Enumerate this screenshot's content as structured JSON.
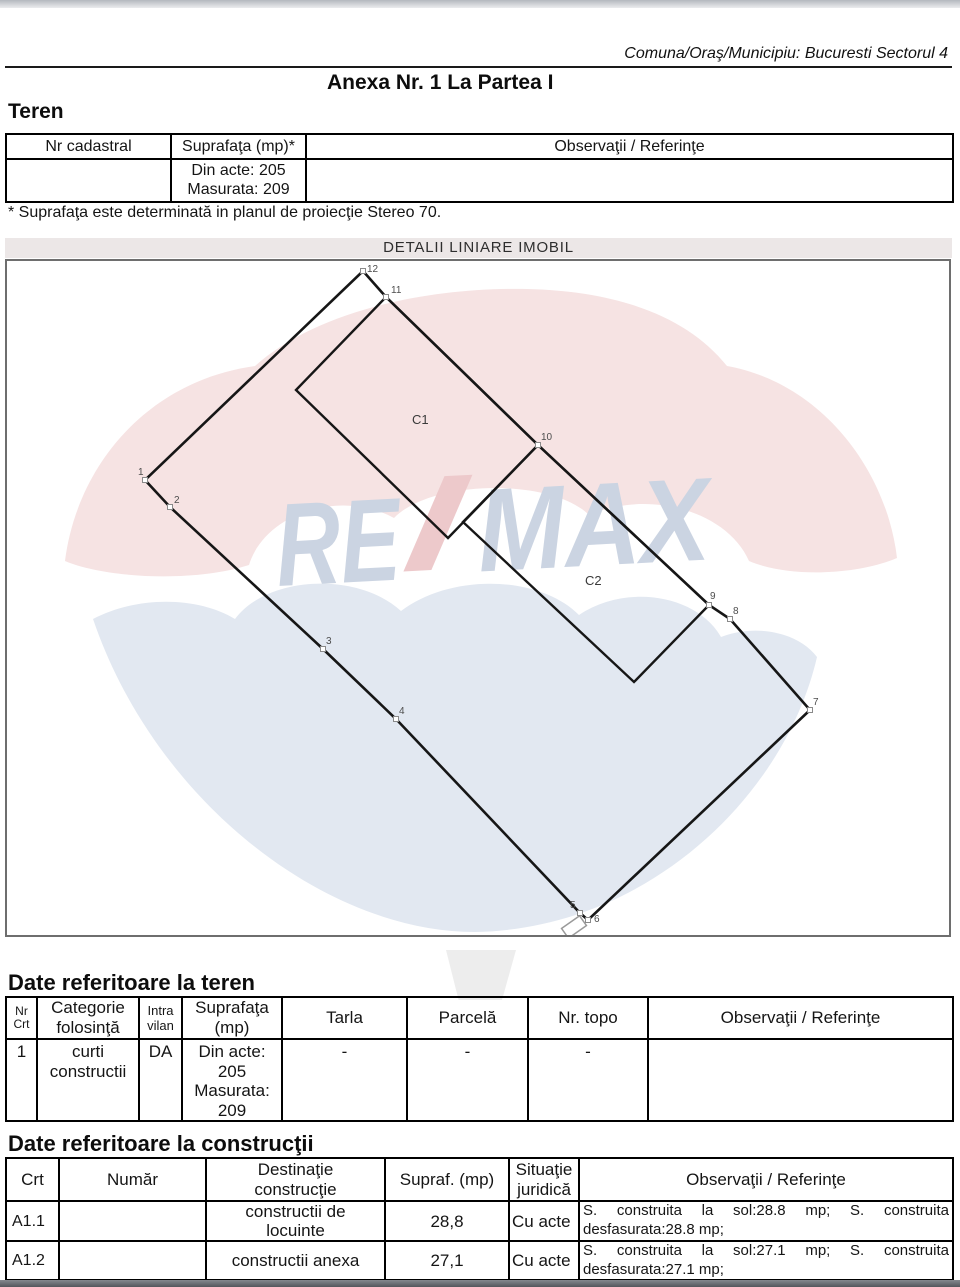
{
  "page": {
    "header_right": "Comuna/Oraş/Municipiu: Bucuresti Sectorul 4",
    "title": "Anexa Nr. 1 La Partea I",
    "teren_heading": "Teren",
    "footnote": "* Suprafaţa este determinată in planul de proiecţie Stereo 70.",
    "detalii_banner": "DETALII LINIARE IMOBIL",
    "date_teren_heading": "Date referitoare la teren",
    "date_constructii_heading": "Date referitoare la construcţii"
  },
  "colors": {
    "banner_bg": "#ece7e7",
    "plan_border": "#6e6e6e",
    "basket_gray": "#ededed"
  },
  "cadastral_table": {
    "headers": [
      "Nr cadastral",
      "Suprafaţa (mp)*",
      "Observaţii / Referinţe"
    ],
    "row": {
      "nr_cadastral": "",
      "suprafata": [
        "Din acte: 205",
        "Masurata: 209"
      ],
      "observatii": ""
    }
  },
  "plan": {
    "building_labels": {
      "c1": "C1",
      "c2": "C2"
    },
    "point_labels": [
      "1",
      "2",
      "3",
      "4",
      "5",
      "6",
      "7",
      "8",
      "9",
      "10",
      "11",
      "12"
    ],
    "watermark": {
      "brand_re": "RE",
      "brand_max": "MAX",
      "pink": "#f6e3e3",
      "blue": "#e2e8f1",
      "letter_blue": "#cbd4e2",
      "letter_red": "#edc9cb"
    }
  },
  "teren_table": {
    "headers": [
      {
        "line1": "Nr",
        "line2": "Crt"
      },
      {
        "line1": "Categorie",
        "line2": "folosinţă"
      },
      {
        "line1": "Intra",
        "line2": "vilan"
      },
      {
        "line1": "Suprafaţa",
        "line2": "(mp)"
      },
      {
        "line1": "Tarla"
      },
      {
        "line1": "Parcelă"
      },
      {
        "line1": "Nr. topo"
      },
      {
        "line1": "Observaţii / Referinţe"
      }
    ],
    "row": {
      "nr_crt": "1",
      "categorie": [
        "curti",
        "constructii"
      ],
      "intravilan": "DA",
      "suprafata": [
        "Din acte:",
        "205",
        "Masurata:",
        "209"
      ],
      "tarla": "-",
      "parcela": "-",
      "nr_topo": "-",
      "observatii": ""
    }
  },
  "constructii_table": {
    "headers": [
      {
        "line1": "Crt"
      },
      {
        "line1": "Număr"
      },
      {
        "line1": "Destinaţie",
        "line2": "construcţie"
      },
      {
        "line1": "Supraf. (mp)"
      },
      {
        "line1": "Situaţie",
        "line2": "juridică"
      },
      {
        "line1": "Observaţii / Referinţe"
      }
    ],
    "rows": [
      {
        "crt": "A1.1",
        "numar": "",
        "destinatie": [
          "constructii de",
          "locuinte"
        ],
        "suprafata": "28,8",
        "situatie": "Cu acte",
        "observatii": "S. construita la sol:28.8 mp; S. construita desfasurata:28.8 mp;"
      },
      {
        "crt": "A1.2",
        "numar": "",
        "destinatie": [
          "constructii anexa"
        ],
        "suprafata": "27,1",
        "situatie": "Cu acte",
        "observatii": "S. construita la sol:27.1 mp; S. construita desfasurata:27.1 mp;"
      }
    ]
  }
}
